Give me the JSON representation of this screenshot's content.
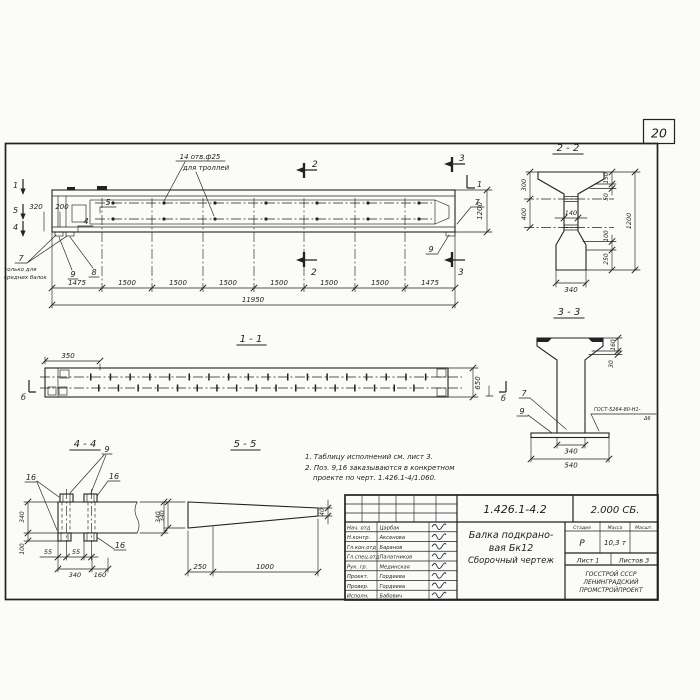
{
  "page": {
    "sheet_number": "20"
  },
  "colors": {
    "ink": "#222222",
    "paper": "#fbfbf9"
  },
  "main_view": {
    "callout_holes_line1": "14 отв.ф25",
    "callout_holes_line2": "для троллей",
    "marker_1": "1",
    "marker_5": "5",
    "marker_4": "4",
    "marker_2": "2",
    "marker_3": "3",
    "dim_320": "320",
    "dim_200": "200",
    "pos_5": "5",
    "pos_4": "4",
    "pos_7_left": "7",
    "pos_7_note_line1": "только для",
    "pos_7_note_line2": "средних балок",
    "pos_9_left": "9",
    "pos_8": "8",
    "pos_7_right": "7",
    "pos_9_right": "9",
    "dim_height": "1200",
    "dim_chain": [
      "1475",
      "1500",
      "1500",
      "1500",
      "1500",
      "1500",
      "1500",
      "1475"
    ],
    "dim_total": "11950"
  },
  "section_2_2": {
    "title": "2 - 2",
    "dim_300": "300",
    "dim_400": "400",
    "dim_140": "140",
    "dim_150": "150",
    "dim_50": "50",
    "dim_1200": "1200",
    "dim_100": "100",
    "dim_250": "250",
    "dim_340": "340"
  },
  "section_3_3": {
    "title": "3 - 3",
    "dim_160": "160",
    "dim_30": "30",
    "pos_7": "7",
    "pos_9": "9",
    "weld_line1": "ГОСТ-5264-80-Н1-",
    "weld_line2": "Δ6",
    "dim_340": "340",
    "dim_540": "540"
  },
  "section_1_1": {
    "title": "1 - 1",
    "dim_350": "350",
    "dim_650": "650",
    "marker_left": "б",
    "marker_right": "б"
  },
  "section_4_4": {
    "title": "4 - 4",
    "pos_9": "9",
    "pos_16": "16",
    "dim_340_left": "340",
    "dim_100": "100",
    "dim_55_a": "55",
    "dim_55_b": "55",
    "dim_340_bottom": "340",
    "dim_160": "160",
    "dim_340_right": "340"
  },
  "section_5_5": {
    "title": "5 - 5",
    "dim_340": "340",
    "dim_250": "250",
    "dim_1000": "1000",
    "dim_40": "40"
  },
  "notes": {
    "line1": "1. Таблицу исполнений см. лист 3.",
    "line2": "2. Поз. 9,16 заказываются в конкретном",
    "line3": "проекте по черт. 1.426.1-4/1.060."
  },
  "title_block": {
    "doc_number": "1.426.1-4.2",
    "doc_code": "2.000 СБ.",
    "rows": [
      {
        "role": "Нач. отд",
        "name": "Царбак"
      },
      {
        "role": "Н.контр.",
        "name": "Аксенова"
      },
      {
        "role": "Гл.кон.отд",
        "name": "Баранов"
      },
      {
        "role": "Гл.спец.отд",
        "name": "Палатников"
      },
      {
        "role": "Рук. гр.",
        "name": "Мединская"
      },
      {
        "role": "Проект.",
        "name": "Гордеева"
      },
      {
        "role": "Провер.",
        "name": "Гордеева"
      },
      {
        "role": "Исполн.",
        "name": "Бабович"
      }
    ],
    "title_line1": "Балка подкрано-",
    "title_line2": "вая Бк12",
    "title_line3": "Сборочный чертеж",
    "stage_header": "Стадия",
    "mass_header": "Масса",
    "scale_header": "Масшт.",
    "stage_value": "Р",
    "mass_value": "10,3 т",
    "sheet_label": "Лист 1",
    "sheets_label": "Листов 3",
    "org_line1": "ГОССТРОЙ СССР",
    "org_line2": "ЛЕНИНГРАДСКИЙ",
    "org_line3": "ПРОМСТРОЙПРОЕКТ"
  }
}
